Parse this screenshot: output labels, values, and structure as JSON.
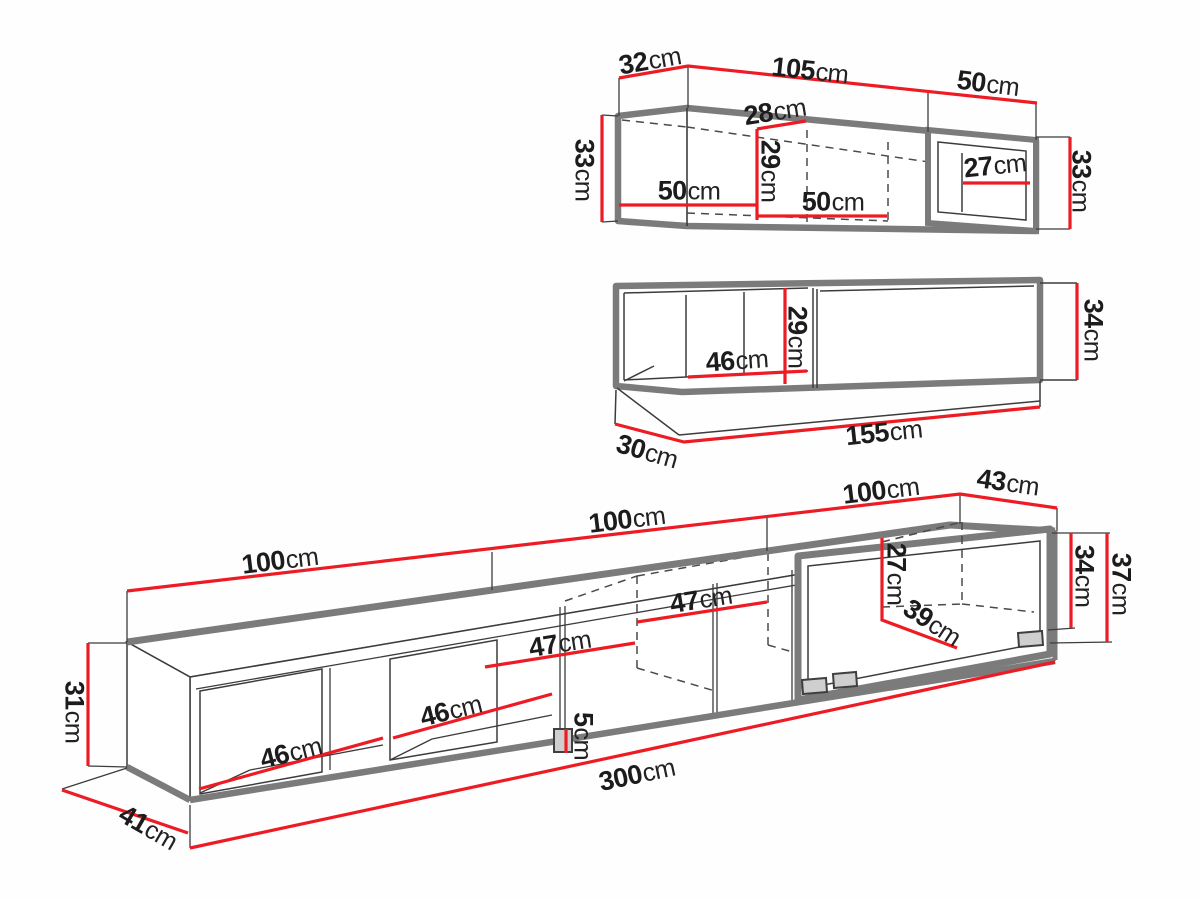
{
  "suffix": "cm",
  "colors": {
    "dimension_line": "#ed1c24",
    "thick_outline": "#7b7b7b",
    "thin_line": "#3c3c3c",
    "label_text": "#1c1c1c"
  },
  "top_unit": {
    "dims": {
      "top_depth": "32",
      "top_front": "105",
      "top_right": "50",
      "height_left": "33",
      "inner_depth": "28",
      "inner_height": "29",
      "inner_width_a": "50",
      "inner_width_b": "50",
      "inner_width_end": "27",
      "height_right": "33"
    }
  },
  "middle_unit": {
    "dims": {
      "inner_height": "29",
      "inner_width": "46",
      "height_right": "34",
      "bottom_depth": "30",
      "bottom_length": "155"
    }
  },
  "bottom_unit": {
    "dims": {
      "top_seg_a": "100",
      "top_seg_b": "100",
      "top_seg_c": "100",
      "top_depth": "43",
      "height_total": "37",
      "height_body": "34",
      "inner_height_right": "27",
      "inner_depth_right": "39",
      "inner_width_mid_a": "47",
      "inner_width_mid_b": "47",
      "inner_width_left_a": "46",
      "inner_width_left_b": "46",
      "foot_height": "5",
      "height_left": "31",
      "total_length": "300",
      "bottom_depth": "41"
    }
  }
}
